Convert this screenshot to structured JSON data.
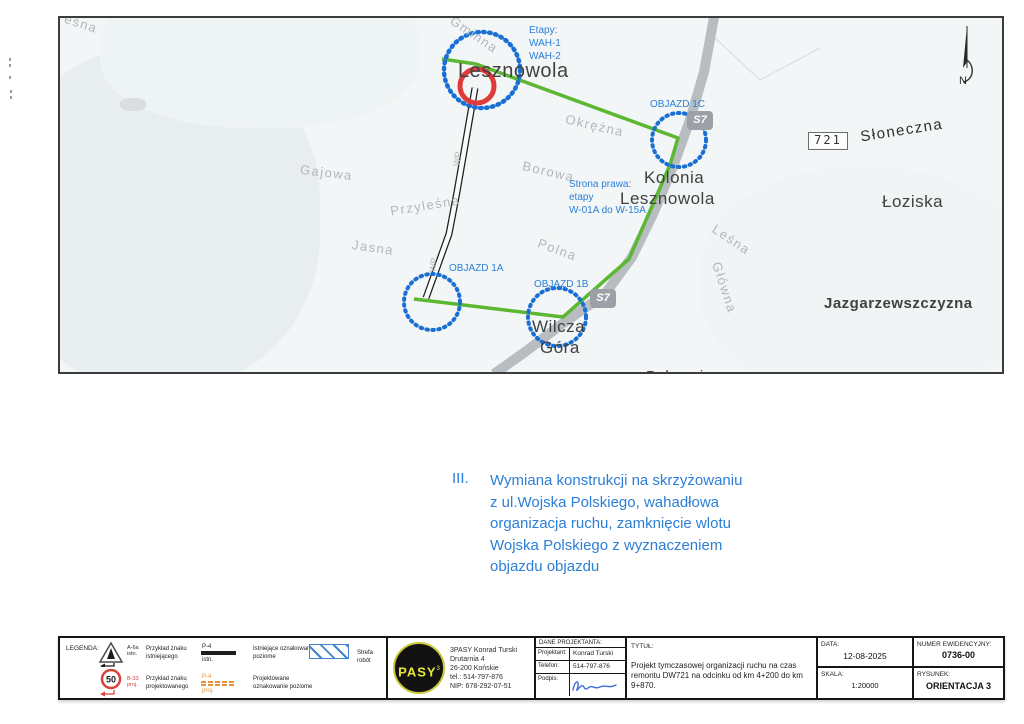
{
  "colors": {
    "annotation_blue": "#2b7fd6",
    "route_green": "#5cb832",
    "detour_circle_blue": "#1a6fd4",
    "closure_red": "#e03a3a",
    "legend_orange": "#e8923c"
  },
  "map": {
    "streets": {
      "lesna_top": "eśna",
      "gminna": "Gminna",
      "okrezna": "Okrężna",
      "borowa": "Borowa",
      "gajowa": "Gajowa",
      "przylesna": "Przyleśna",
      "jasna": "Jasna",
      "polna": "Polna",
      "lesna": "Leśna",
      "glowna": "Główna",
      "sloneczna": "Słoneczna",
      "wp_1": "WP",
      "wp_2": "WP"
    },
    "places": {
      "lesznowola": "Lesznowola",
      "kolonia_1": "Kolonia",
      "kolonia_2": "Lesznowola",
      "wilcza_1": "Wilcza",
      "wilcza_2": "Góra",
      "loziska": "Łoziska",
      "jazgarzewszczyzna": "Jazgarzewszczyzna",
      "bobrowiec": "Bobrowiec"
    },
    "annotations": {
      "etapy_1": "Etapy:",
      "etapy_2": "WAH-1",
      "etapy_3": "WAH-2",
      "strona_1": "Strona prawa:",
      "strona_2": "etapy",
      "strona_3": "W-01A do W-15A",
      "objazd_1a": "OBJAZD 1A",
      "objazd_1b": "OBJAZD 1B",
      "objazd_1c": "OBJAZD 1C"
    },
    "shields": {
      "s7_north": "S7",
      "s7_south": "S7",
      "dw721": "721"
    },
    "north_label": "N"
  },
  "note": {
    "numeral": "III.",
    "line_1": "Wymiana konstrukcji na skrzyżowaniu",
    "line_2": "z ul.Wojska Polskiego, wahadłowa",
    "line_3": "organizacja ruchu, zamknięcie wlotu",
    "line_4": "Wojska Polskiego z wyznaczeniem",
    "line_5": "objazdu objazdu"
  },
  "legend": {
    "title": "LEGENDA:",
    "sign_existing_code": "A-6a",
    "sign_existing_suffix": "istn.",
    "sign_existing_label": "Przykład znaku istniejącego",
    "marking_existing_code": "P-4",
    "marking_existing_suffix": "istn.",
    "marking_existing_label": "Istniejące oznakowanie poziome",
    "work_zone_label": "Strefa robót",
    "sign_projected_value": "50",
    "sign_projected_code": "B-33",
    "sign_projected_suffix": "proj.",
    "sign_projected_label": "Przykład znaku projektowanego",
    "marking_projected_code": "P-4",
    "marking_projected_suffix": "proj.",
    "marking_projected_label": "Projektowane oznakowanie poziome"
  },
  "company": {
    "logo_text": "PASY",
    "logo_sup": "3",
    "name": "3PASY Konrad Turski",
    "address_1": "Drutarnia 4",
    "address_2": "26-200 Końskie",
    "phone": "tel.: 514-797-876",
    "nip": "NIP: 678-292-07-51"
  },
  "designer": {
    "header": "DANE PROJEKTANTA:",
    "row_1_label": "Projektant:",
    "row_1_value": "Konrad Turski",
    "row_2_label": "Telefon:",
    "row_2_value": "514-797-876",
    "row_3_label": "Podpis:"
  },
  "title_block": {
    "title_label": "TYTUŁ:",
    "title_text": "Projekt tymczasowej organizacji ruchu na czas remontu DW721 na odcinku od km 4+200 do km 9+870.",
    "date_label": "DATA:",
    "date_value": "12-08-2025",
    "scale_label": "SKALA:",
    "scale_value": "1:20000",
    "number_label": "NUMER EWIDENCYJNY:",
    "number_value": "0736-00",
    "drawing_label": "RYSUNEK:",
    "drawing_value": "ORIENTACJA 3"
  }
}
